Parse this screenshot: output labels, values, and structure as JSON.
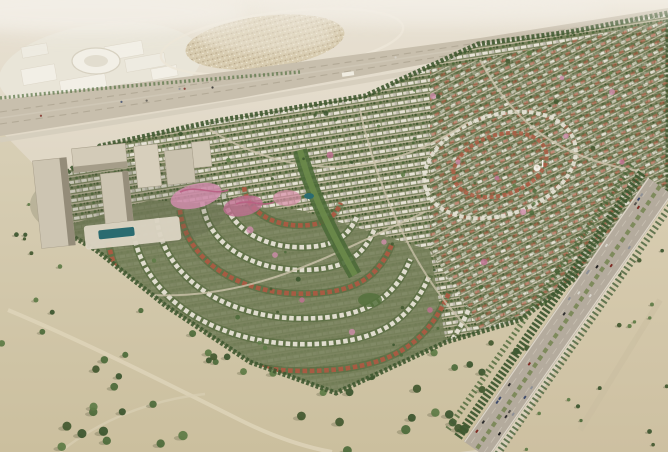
{
  "meta": {
    "description": "Aerial 3D masterplan render of a desert residential community: villa districts with curving streets, a mid-rise hotel and waterpark cluster, a mall with ring-shaped building and a souk loop beyond a highway, flanked by tree-dotted desert and a busy divided road"
  },
  "palette": {
    "desert_far": "#e6dfd0",
    "desert_mid": "#ded5c2",
    "desert_near": "#d4caad",
    "desert_near_deep": "#cbbf9e",
    "desert_right": "#d6cbaf",
    "desert_right_deep": "#cdc0a1",
    "haze": "#f3efe7",
    "highway": "#c8bfad",
    "highway_lane": "#b3aa97",
    "frontage": "#d5cdbd",
    "road": "#b4ab9d",
    "road_edge": "#ddd6c8",
    "road_lane": "#c6beb0",
    "median_green": "#7e8a5c",
    "tree_belt": "#3f5830",
    "tree_colors": [
      "#3b552e",
      "#4c6a39",
      "#5d7b45",
      "#42582f"
    ],
    "tree_shadow": "#6b6b4d",
    "fabric_base": "#78815b",
    "villa_white": "#e7e3d6",
    "villa_red": "#ab5a42",
    "street": "#cdc4ac",
    "valley_green": "#4d6a38",
    "valley_light": "#6c8a4a",
    "tower_face": "#cdc5b2",
    "tower_face_light": "#d7cfbc",
    "tower_shade": "#948c79",
    "podium": "#dcd5c4",
    "pool": "#2a6b70",
    "pink": "#d08cab",
    "pink_deep": "#c06f92",
    "mall_white": "#f2efe6",
    "mall_base": "#e9e5d8",
    "ring_stroke": "#d7d1c1",
    "souk": "#d8ccb0",
    "loop_road": "#ece6d7",
    "dirt_path": "#ded4ba",
    "mosque_white": "#f2efe7",
    "car_colors": [
      "#2e2e2e",
      "#55524c",
      "#7d2a22",
      "#d9d6cd",
      "#8d9096",
      "#3c4a6b",
      "#1f1f1f"
    ]
  },
  "scene": {
    "regions": [
      {
        "name": "mall-complex",
        "label": "mall with ring-shaped building"
      },
      {
        "name": "souk-loop",
        "label": "souk cluster inside loop road"
      },
      {
        "name": "main-highway",
        "label": "diagonal highway corridor"
      },
      {
        "name": "villa-fabric",
        "label": "dense villa and townhouse districts"
      },
      {
        "name": "tower-cluster",
        "label": "mid-rise towers with waterpark and pool"
      },
      {
        "name": "desert-left",
        "label": "tree-dotted desert foreground"
      },
      {
        "name": "side-road",
        "label": "divided road with traffic"
      },
      {
        "name": "desert-right",
        "label": "desert beyond side road"
      }
    ],
    "counts": {
      "desert_left_trees": 150,
      "desert_right_trees": 30,
      "fabric_trees": 95,
      "cars": 26,
      "highway_cars": 8
    },
    "crescent_radii": [
      232,
      205,
      178,
      152,
      127,
      103,
      80,
      58
    ],
    "blossoms": [
      [
        433,
        96
      ],
      [
        458,
        162
      ],
      [
        497,
        178
      ],
      [
        523,
        212
      ],
      [
        562,
        78
      ],
      [
        612,
        92
      ],
      [
        384,
        242
      ],
      [
        302,
        300
      ],
      [
        352,
        332
      ],
      [
        566,
        136
      ],
      [
        622,
        162
      ],
      [
        484,
        262
      ],
      [
        430,
        310
      ],
      [
        275,
        255
      ],
      [
        330,
        155
      ],
      [
        250,
        230
      ]
    ]
  }
}
